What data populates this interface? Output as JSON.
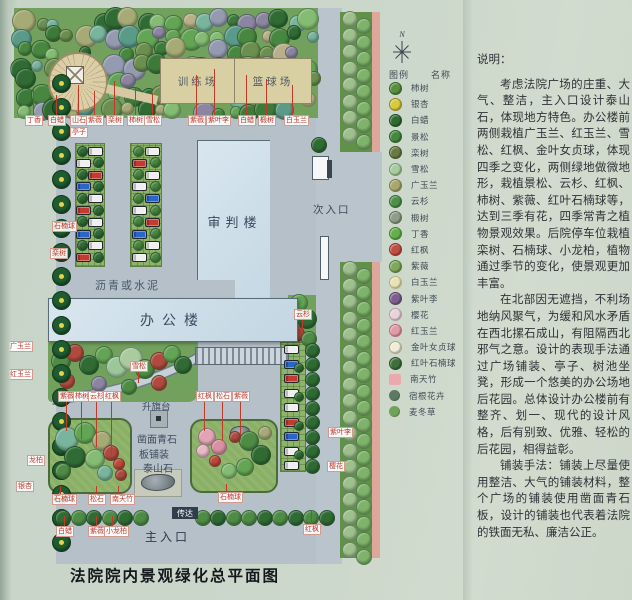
{
  "title": "法院院内景观绿化总平面图",
  "plan": {
    "buildings": {
      "trial": "审判楼",
      "office": "办公楼"
    },
    "areas": {
      "training": "训练场",
      "basketball": "篮球场",
      "entrance_secondary": "次入口",
      "entrance_main": "主入口",
      "reception": "传达",
      "flag_platform": "升旗台",
      "paving_note": "沥青或水泥",
      "plaza_paving_line1": "凿面青石",
      "plaza_paving_line2": "板铺装",
      "stone": "泰山石"
    },
    "mini_labels": [
      {
        "t": "丁香",
        "x": 17,
        "y": 107,
        "lu": 26
      },
      {
        "t": "白蜡",
        "x": 40,
        "y": 107,
        "lu": 20
      },
      {
        "t": "山石",
        "x": 62,
        "y": 107,
        "lu": 30
      },
      {
        "t": "紫薇",
        "x": 78,
        "y": 107,
        "lu": 24
      },
      {
        "t": "栾树",
        "x": 98,
        "y": 107,
        "lu": 34
      },
      {
        "t": "柿树",
        "x": 119,
        "y": 107,
        "lu": 28
      },
      {
        "t": "雪松",
        "x": 136,
        "y": 107,
        "lu": 22
      },
      {
        "t": "紫薇",
        "x": 180,
        "y": 107,
        "lu": 40
      },
      {
        "t": "紫叶李",
        "x": 198,
        "y": 107,
        "lu": 46
      },
      {
        "t": "白蜡",
        "x": 230,
        "y": 107,
        "lu": 40
      },
      {
        "t": "椴树",
        "x": 250,
        "y": 107,
        "lu": 36
      },
      {
        "t": "白玉兰",
        "x": 276,
        "y": 107,
        "lu": 30
      },
      {
        "t": "亭子",
        "x": 62,
        "y": 119
      },
      {
        "t": "石楠球",
        "x": 44,
        "y": 213
      },
      {
        "t": "栾树",
        "x": 42,
        "y": 240
      },
      {
        "t": "广玉兰",
        "x": 0,
        "y": 333
      },
      {
        "t": "红玉兰",
        "x": 0,
        "y": 361
      },
      {
        "t": "雪松",
        "x": 122,
        "y": 353,
        "ld": 12
      },
      {
        "t": "云杉",
        "x": 286,
        "y": 301,
        "ld": 14
      },
      {
        "t": "紫薇",
        "x": 50,
        "y": 383,
        "ld": 30
      },
      {
        "t": "柿树",
        "x": 65,
        "y": 383,
        "ld": 38
      },
      {
        "t": "云杉",
        "x": 80,
        "y": 383,
        "ld": 46
      },
      {
        "t": "红枫",
        "x": 95,
        "y": 383,
        "ld": 55
      },
      {
        "t": "红枫",
        "x": 188,
        "y": 383,
        "ld": 30
      },
      {
        "t": "松石",
        "x": 206,
        "y": 383,
        "ld": 40
      },
      {
        "t": "紫薇",
        "x": 224,
        "y": 383,
        "ld": 34
      },
      {
        "t": "龙柏",
        "x": 19,
        "y": 447
      },
      {
        "t": "银杏",
        "x": 8,
        "y": 473
      },
      {
        "t": "石楠球",
        "x": 44,
        "y": 486,
        "lu": 8
      },
      {
        "t": "松石",
        "x": 80,
        "y": 486,
        "lu": 8
      },
      {
        "t": "南天竹",
        "x": 102,
        "y": 486,
        "lu": 8
      },
      {
        "t": "石楠球",
        "x": 210,
        "y": 484,
        "lu": 8
      },
      {
        "t": "白蜡",
        "x": 48,
        "y": 518,
        "lu": 10
      },
      {
        "t": "紫薇",
        "x": 80,
        "y": 518,
        "lu": 10
      },
      {
        "t": "小龙柏",
        "x": 96,
        "y": 518,
        "lu": 10
      },
      {
        "t": "紫叶李",
        "x": 320,
        "y": 419
      },
      {
        "t": "樱花",
        "x": 319,
        "y": 453
      },
      {
        "t": "红枫",
        "x": 295,
        "y": 516,
        "lu": 14
      }
    ]
  },
  "legend": {
    "north": "N",
    "header_symbol": "图例",
    "header_name": "名称",
    "items": [
      {
        "name": "柿树",
        "color": "#5a8f3e",
        "ring": "#2f5f2a"
      },
      {
        "name": "银杏",
        "color": "#d9c93c",
        "ring": "#8f8520"
      },
      {
        "name": "白蜡",
        "color": "#2f6b30",
        "ring": "#1d4a20"
      },
      {
        "name": "景松",
        "color": "#44883f",
        "ring": "#2a5f28"
      },
      {
        "name": "栾树",
        "color": "#6b7a40",
        "ring": "#44522a"
      },
      {
        "name": "雪松",
        "color": "#a9cb9f",
        "ring": "#6f9a68"
      },
      {
        "name": "广玉兰",
        "color": "#a9a671",
        "ring": "#7a7848"
      },
      {
        "name": "云杉",
        "color": "#4f8f4a",
        "ring": "#2f6b2e"
      },
      {
        "name": "椴树",
        "color": "#8e9c88",
        "ring": "#5f6e5a"
      },
      {
        "name": "丁香",
        "color": "#66b04c",
        "ring": "#3f7f30"
      },
      {
        "name": "红枫",
        "color": "#bf4f44",
        "ring": "#8f2f28"
      },
      {
        "name": "紫薇",
        "color": "#7fa85a",
        "ring": "#4f7a36"
      },
      {
        "name": "白玉兰",
        "color": "#e9e2b4",
        "ring": "#b8ae7a"
      },
      {
        "name": "紫叶李",
        "color": "#7c5f8e",
        "ring": "#54406b"
      },
      {
        "name": "樱花",
        "color": "#e7d3da",
        "ring": "#b89aa6"
      },
      {
        "name": "红玉兰",
        "color": "#e39aa6",
        "ring": "#b96a7a"
      },
      {
        "name": "金叶女贞球",
        "color": "#f0ecd9",
        "ring": "#b0a87f"
      },
      {
        "name": "红叶石楠球",
        "color": "#3f6f3a",
        "ring": "#264f24"
      },
      {
        "name": "南天竹",
        "color": "#eba9ad",
        "shape": "square"
      },
      {
        "name": "宿根花卉",
        "color": "#5c7a63",
        "shape": "flat"
      },
      {
        "name": "麦冬草",
        "color": "#6fa35c",
        "shape": "flat"
      }
    ]
  },
  "description": {
    "heading": "说明：",
    "paragraphs": [
      "考虑法院广场的庄重、大气、整洁，主入口设计泰山石，体现地方特色。办公楼前两侧栽植广玉兰、红玉兰、雪松、红枫、金叶女贞球，体现四季之变化，两侧绿地做微地形，栽植景松、云杉、红枫、柿树、紫薇、红叶石楠球等，达到三季有花，四季常青之植物景观效果。后院停车位栽植栾树、石楠球、小龙柏，植物通过季节的变化，使景观更加丰富。",
      "在北部因无遮挡，不利场地纳风聚气，为缓和风水矛盾在西北摞石成山，有阻隔西北邪气之意。设计的表现手法通过广场铺装、亭子、树池坐凳，形成一个悠美的办公场地后花园。总体设计办公楼前有整齐、划一、现代的设计风格，后有别致、优雅、轻松的后花园，相得益彰。",
      "铺装手法：铺装上尽量使用整洁、大气的铺装材料，整个广场的铺装使用凿面青石板，设计的铺装也代表着法院的铁面无私、廉洁公正。"
    ]
  }
}
